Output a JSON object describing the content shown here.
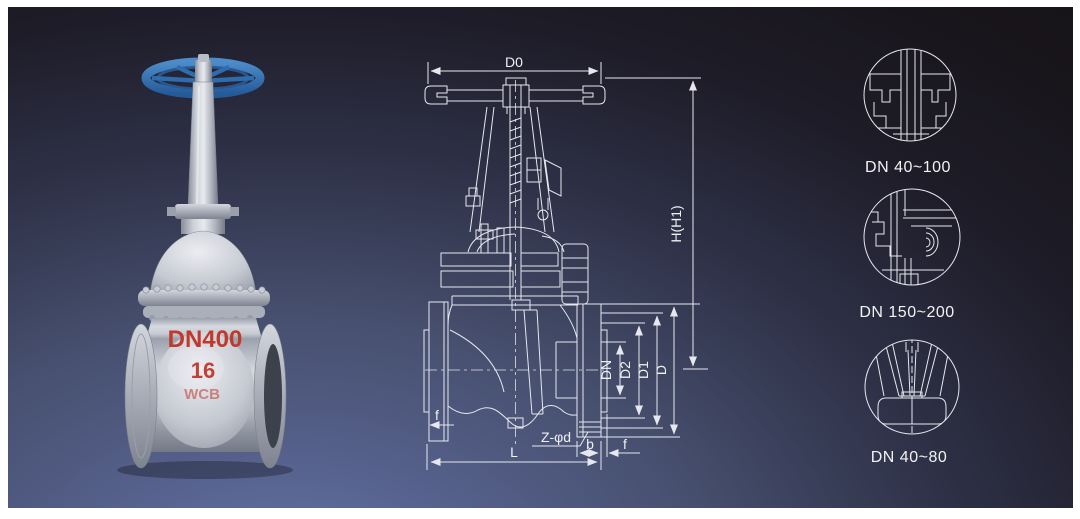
{
  "colors": {
    "frame_white": "#ffffff",
    "background_blue": "#5d6da0",
    "background_dark": "#17141a",
    "line_white": "#e6e8ee",
    "handwheel_blue": "#2e6db6",
    "marking_red": "#c0392b",
    "valve_steel_gray": "#c8ccd4"
  },
  "photo": {
    "markings": {
      "size": "DN400",
      "pressure_class": "16",
      "body_material": "WCB"
    }
  },
  "drawing": {
    "dim_labels": {
      "d0": "D0",
      "height": "H(H1)",
      "dn": "DN",
      "d2": "D2",
      "d1": "D1",
      "d": "D",
      "f": "f",
      "b": "b",
      "length": "L",
      "bolt_holes": "Z-φd"
    }
  },
  "details": [
    {
      "label": "DN 40~100"
    },
    {
      "label": "DN 150~200"
    },
    {
      "label": "DN 40~80"
    }
  ]
}
